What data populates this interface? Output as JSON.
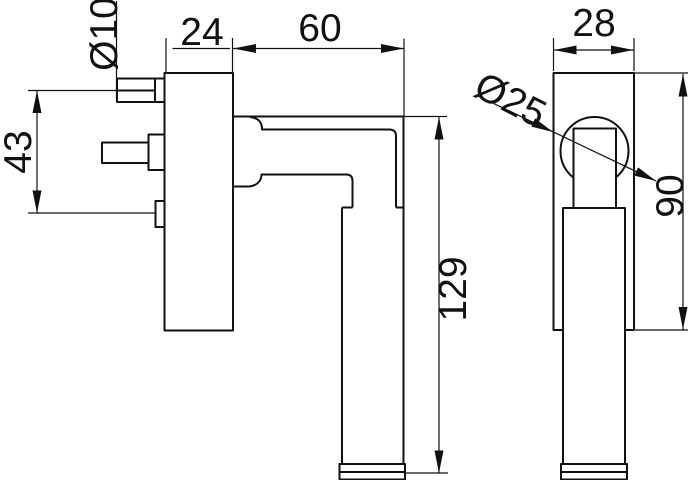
{
  "drawing": {
    "background": "#ffffff",
    "line_color": "#111111",
    "labels": {
      "screw_diameter": "Ø10",
      "front_plate_width": "24",
      "handle_reach": "60",
      "screw_spacing": "43",
      "handle_length": "129",
      "side_plate_width": "28",
      "neck_diameter": "Ø25",
      "plate_height": "90"
    }
  }
}
